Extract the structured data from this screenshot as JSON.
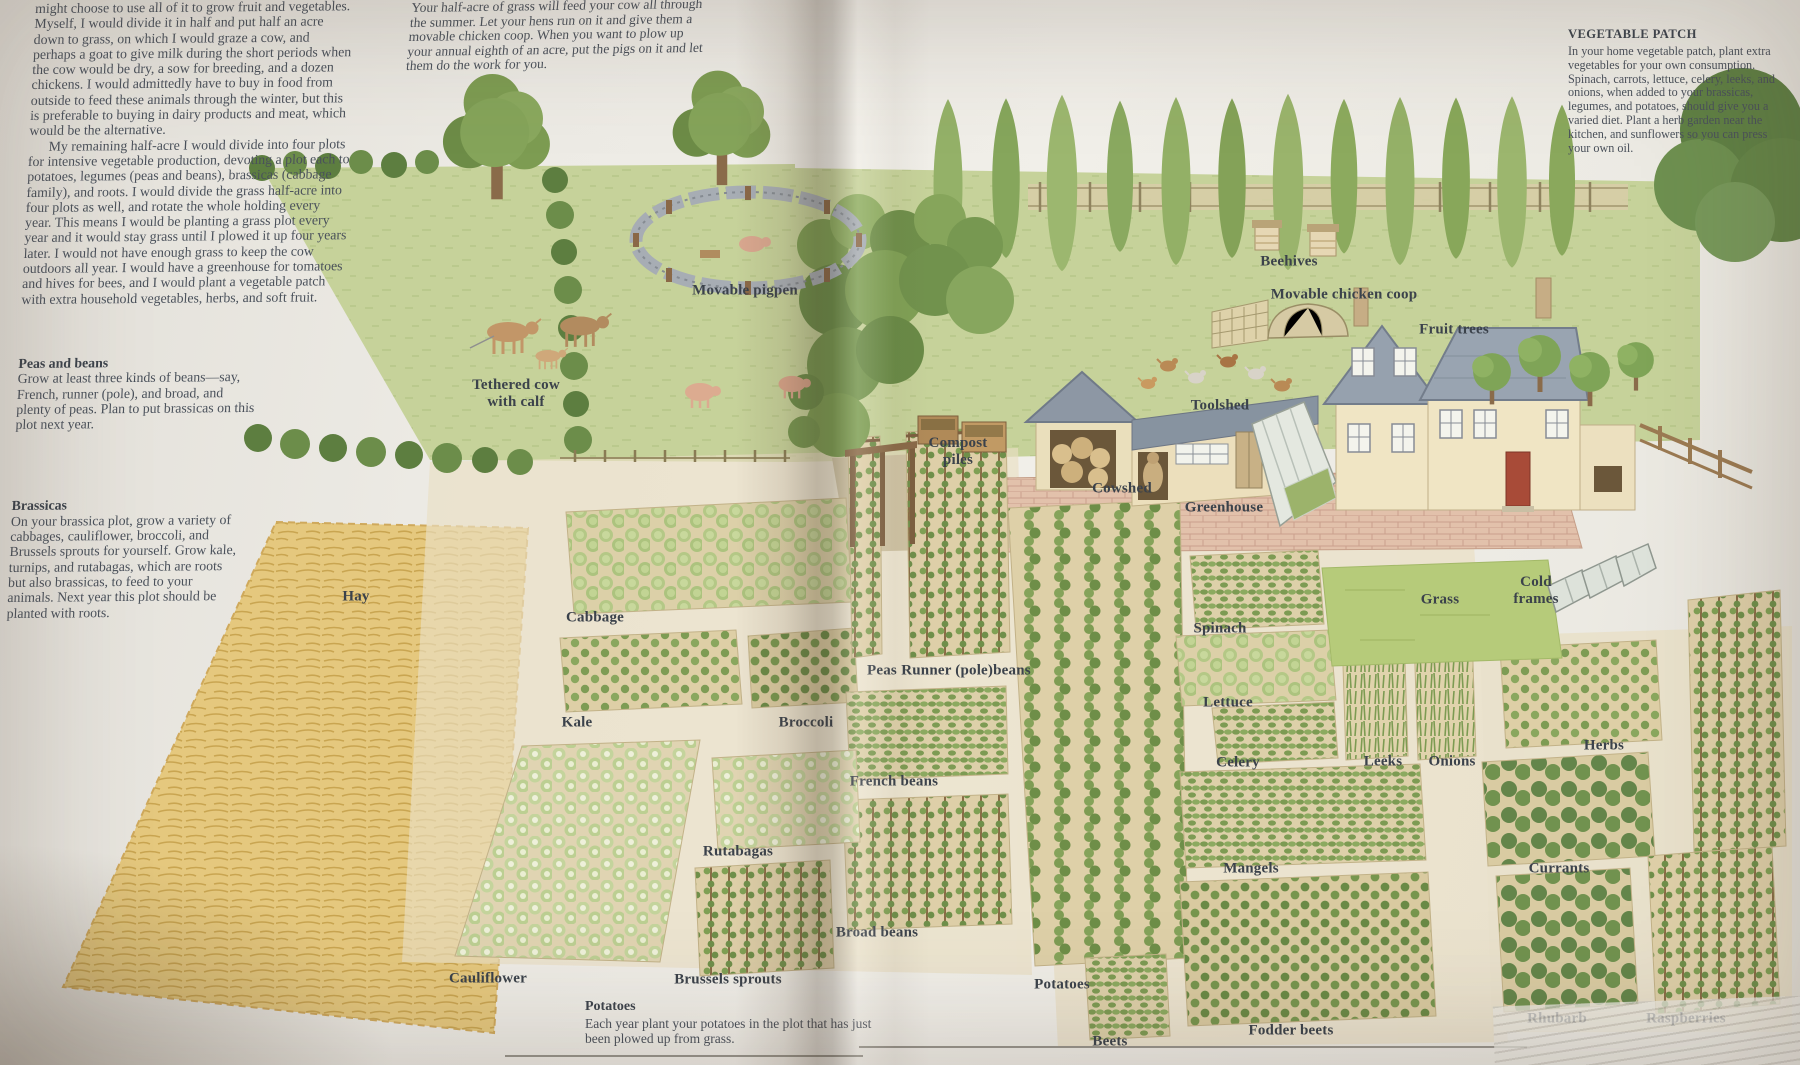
{
  "page": {
    "left": {
      "intro_cut_line": "good, well-drained land, you",
      "intro_p1": "might choose to use all of it to grow fruit and vegetables. Myself, I would divide it in half and put half an acre down to grass, on which I would graze a cow, and perhaps a goat to give milk during the short periods when the cow would be dry, a sow for breeding, and a dozen chickens. I would admittedly have to buy in food from outside to feed these animals through the winter, but this is preferable to buying in dairy products and meat, which would be the alternative.",
      "intro_p2": "My remaining half-acre I would divide into four plots for intensive vegetable production, devoting a plot each to potatoes, legumes (peas and beans), brassicas (cabbage family), and roots. I would divide the grass half-acre into four plots as well, and rotate the whole holding every year. This means I would be planting a grass plot every year and it would stay grass until I plowed it up four years later. I would not have enough grass to keep the cow outdoors all year. I would have a greenhouse for tomatoes and hives for bees, and I would plant a vegetable patch with extra household vegetables, herbs, and soft fruit.",
      "peas_beans_heading": "Peas and beans",
      "peas_beans_body": "Grow at least three kinds of beans—say, French, runner (pole), and broad, and plenty of peas. Plan to put brassicas on this plot next year.",
      "brassicas_heading": "Brassicas",
      "brassicas_body": "On your brassica plot, grow a variety of cabbages, cauliflower, broccoli, and Brussels sprouts for yourself. Grow kale, turnips, and rutabagas, which are roots but also brassicas, to feed to your animals. Next year this plot should be planted with roots."
    },
    "top_middle": "Your half-acre of grass will feed your cow all through the summer. Let your hens run on it and give them a movable chicken coop. When you want to plow up your annual eighth of an acre, put the pigs on it and let them do the work for you.",
    "right": {
      "vegetable_patch_heading": "VEGETABLE PATCH",
      "vegetable_patch_body": "In your home vegetable patch, plant extra vegetables for your own consumption. Spinach, carrots, lettuce, celery, leeks, and onions, when added to your brassicas, legumes, and potatoes, should give you a varied diet. Plant a herb garden near the kitchen, and sunflowers so you can press your own oil."
    },
    "bottom_caption": {
      "heading": "Potatoes",
      "body": "Each year plant your potatoes in the plot that has just been plowed up from grass."
    }
  },
  "labels": {
    "movable_pigpen": "Movable pigpen",
    "tethered_cow": "Tethered cow with calf",
    "beehives": "Beehives",
    "movable_chicken_coop": "Movable chicken coop",
    "fruit_trees": "Fruit trees",
    "toolshed": "Toolshed",
    "compost_piles": "Compost piles",
    "cowshed": "Cowshed",
    "greenhouse": "Greenhouse",
    "hay": "Hay",
    "cabbage": "Cabbage",
    "grass": "Grass",
    "cold_frames": "Cold frames",
    "spinach": "Spinach",
    "peas": "Peas",
    "runner_beans": "Runner (pole)beans",
    "lettuce": "Lettuce",
    "kale": "Kale",
    "broccoli": "Broccoli",
    "french_beans": "French beans",
    "celery": "Celery",
    "leeks": "Leeks",
    "onions": "Onions",
    "herbs": "Herbs",
    "rutabagas": "Rutabagas",
    "mangels": "Mangels",
    "currants": "Currants",
    "broad_beans": "Broad beans",
    "cauliflower": "Cauliflower",
    "brussels_sprouts": "Brussels sprouts",
    "potatoes": "Potatoes",
    "beets": "Beets",
    "fodder_beets": "Fodder beets",
    "rhubarb": "Rhubarb",
    "raspberries": "Raspberries"
  },
  "palette": {
    "paper": "#efede7",
    "ink": "#4a515b",
    "label_ink": "#3b424b",
    "meadow_green": "#c6d29a",
    "lawn_green": "#b6cb7a",
    "hay_yellow": "#e5c87e",
    "soil_tan": "#e9dfc2",
    "roof_gray": "#96a1ae",
    "wall_cream": "#f0e5c4",
    "brick_pink": "#e2c1ab",
    "door_red": "#a84b38"
  }
}
